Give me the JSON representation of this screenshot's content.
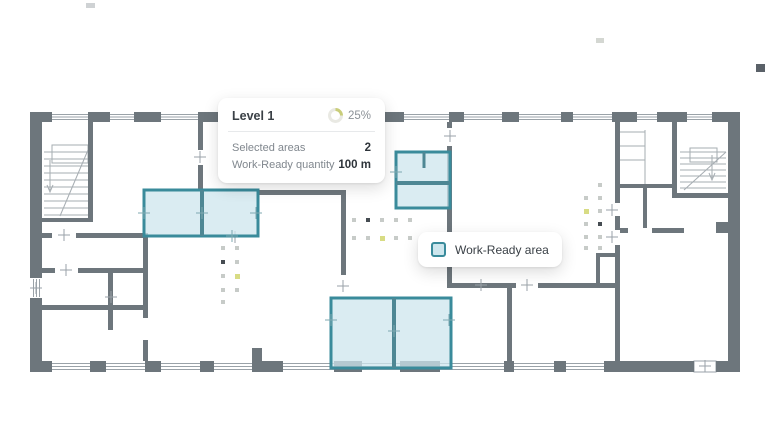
{
  "panel": {
    "level_label": "Level 1",
    "progress_percent": "25%",
    "rows": [
      {
        "label": "Selected areas",
        "value": "2"
      },
      {
        "label": "Work-Ready quantity",
        "value": "100 m"
      }
    ]
  },
  "legend": {
    "label": "Work-Ready area"
  },
  "progress": {
    "percent": 25
  },
  "icons": {
    "progress_ring": "progress-ring-icon",
    "legend_swatch": "work-ready-swatch-icon"
  },
  "colors": {
    "accent_teal": "#3a8b9b",
    "teal_fill": "#cde6ed",
    "wall_gray": "#6d767c",
    "line_gray": "#9aa2a8",
    "progress_arc": "#c9cd7a",
    "progress_track": "#e9e9e3",
    "dot_light": "#c7cbc8",
    "dot_dark": "#464c52",
    "dot_yellow": "#d8dc84"
  }
}
